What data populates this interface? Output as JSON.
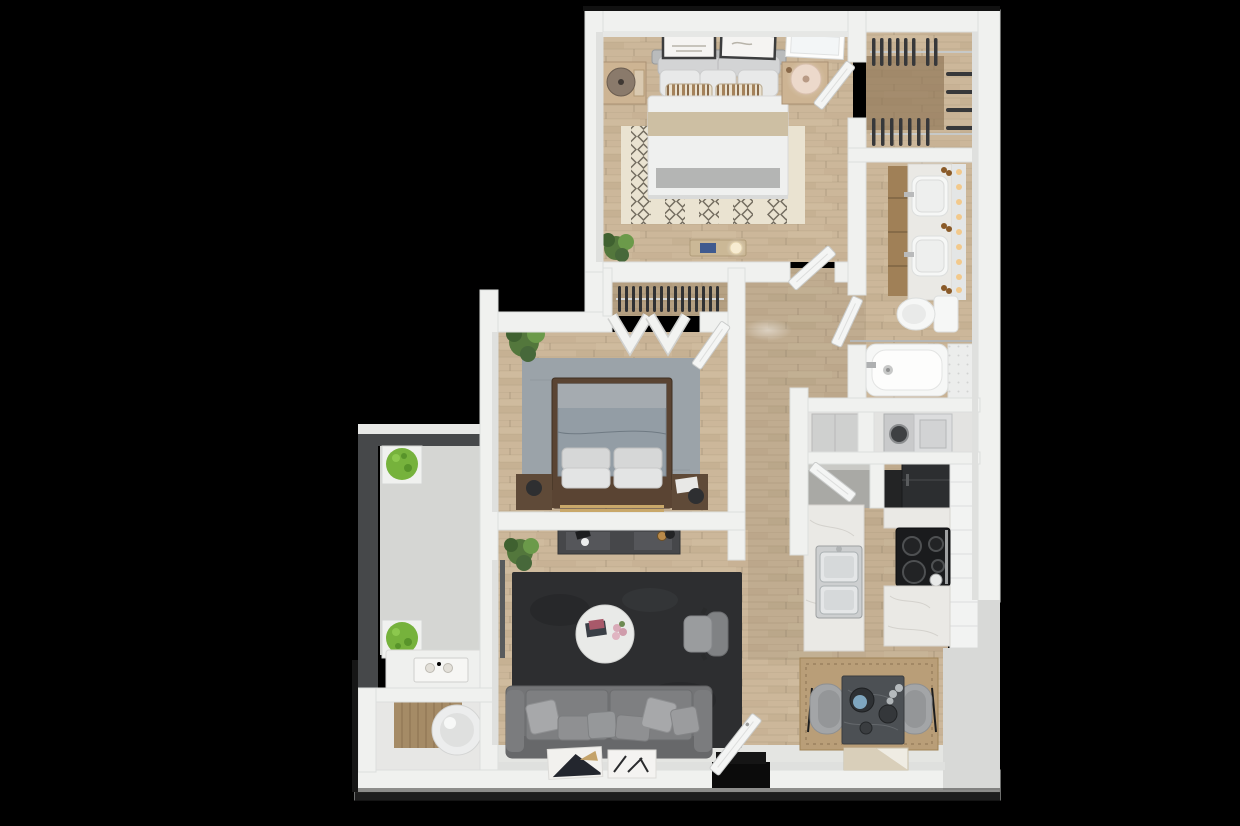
{
  "scene": {
    "type": "3d-floor-plan-render",
    "view": "top-down",
    "unit": "two-bedroom apartment with bathroom, walk-in closet, laundry, kitchen, living-dining area, balcony and storage room",
    "visible_text": "none"
  },
  "rooms": [
    {
      "name": "master-bedroom",
      "furniture": [
        "king-bed",
        "headboard-pillows",
        "striped-accent-pillows",
        "tan-blanket",
        "patterned-area-rug",
        "nightstand-left-with-lamp",
        "nightstand-right-with-lamp",
        "wall-art-frame-1",
        "wall-art-frame-2",
        "window",
        "foot-bench-with-book-and-lamp",
        "potted-plant"
      ]
    },
    {
      "name": "walk-in-closet",
      "furniture": [
        "hanging-clothes-top-rail",
        "hanging-clothes-bottom-rail",
        "hanging-clothes-side-rail",
        "wood-floor"
      ]
    },
    {
      "name": "bathroom",
      "furniture": [
        "double-vanity",
        "two-sinks",
        "mirror-light-strip",
        "amber-bottles",
        "toilet",
        "bathtub",
        "tub-faucet",
        "tile-surround",
        "shower-rod"
      ]
    },
    {
      "name": "laundry-closet",
      "furniture": [
        "utility-cabinet",
        "washer",
        "dryer"
      ]
    },
    {
      "name": "kitchen",
      "furniture": [
        "pantry-closet",
        "refrigerator",
        "cooktop-range",
        "white-cabinet-run",
        "marble-counters",
        "peninsula-with-double-sink"
      ]
    },
    {
      "name": "bedroom-2",
      "furniture": [
        "queen-bed",
        "gray-duvet",
        "pillows",
        "gray-area-rug",
        "nightstand-left",
        "nightstand-right-with-magazine",
        "reach-in-closet-with-hangers",
        "bifold-closet-doors",
        "potted-plant",
        "gold-footboard-trim"
      ]
    },
    {
      "name": "hallway",
      "furniture": [
        "ceiling-light-glow"
      ]
    },
    {
      "name": "living-room",
      "furniture": [
        "media-console",
        "console-objects",
        "potted-plant",
        "dark-area-rug",
        "round-coffee-table",
        "books",
        "pink-flowers",
        "armchair",
        "sofa",
        "throw-pillows",
        "leaning-art-frame-1",
        "leaning-art-frame-2",
        "balcony-slider-track"
      ]
    },
    {
      "name": "dining-area",
      "furniture": [
        "square-stone-table",
        "dining-chair-left",
        "dining-chair-right",
        "tan-area-rug",
        "plates-and-bowl",
        "glasses",
        "two-tone-floor-mat"
      ]
    },
    {
      "name": "entry",
      "furniture": [
        "open-front-door",
        "dark-door-mat",
        "door-opening"
      ]
    },
    {
      "name": "balcony",
      "furniture": [
        "dark-railing",
        "planter-box-top",
        "planter-box-bottom",
        "bench-table-with-tray",
        "concrete-floor"
      ]
    },
    {
      "name": "storage-room",
      "furniture": [
        "water-heater-cylinder",
        "wood-accent-wall"
      ]
    }
  ],
  "doors": [
    "master-closet-door",
    "master-entry-door",
    "bathroom-door",
    "bedroom2-entry-door",
    "bedroom2-bifold-doors",
    "pantry-door",
    "front-entry-door"
  ],
  "colors": {
    "background": "#000000",
    "wall": "#f0f1ef",
    "wall_shade": "#dfe0de",
    "wall_face": "#d8d9d7",
    "wood_floor": "#ccb79a",
    "wood_lines": "#b3a083",
    "closet_wood": "#8d7354",
    "concrete": "#d5d6d3",
    "tile_entry": "#e4e5e2",
    "storage_floor": "#e7e7e5",
    "master_rug": "#eae3d1",
    "rug_pattern": "#5f584c",
    "bedroom2_rug": "#9ba3a9",
    "living_rug": "#2d2e30",
    "dining_rug": "#b99e78",
    "sofa": "#737476",
    "armchair": "#9a9c9e",
    "chair": "#a3a5a7",
    "coffee_table": "#e9eae8",
    "console": "#46474a",
    "dining_table": "#4c5054",
    "bed_frame": "#5a4433",
    "duvet_master": "#eff0ef",
    "duvet_bedroom2": "#939da5",
    "blanket_tan": "#cdbfa3",
    "nightstand_wood": "#cdb493",
    "nightstand_dark": "#5f4a38",
    "appliance_dark": "#2c2e30",
    "stove": "#1a1b1d",
    "marble": "#eae9e5",
    "cabinet_white": "#f2f3f2",
    "cabinet_wood": "#a08057",
    "fixture_white": "#f6f7f6",
    "hanger": "#37383a",
    "plant": "#53773c",
    "shrub": "#76b23c",
    "railing": "#46484a",
    "lamp_warm": "#f2c98c",
    "door": "#f4f5f4",
    "mat_dark": "#151515",
    "art_dark": "#23262e",
    "accent_blue": "#3f5a8f",
    "bowl_blue": "#7fa6bf",
    "accent_gold": "#c9a86a"
  }
}
